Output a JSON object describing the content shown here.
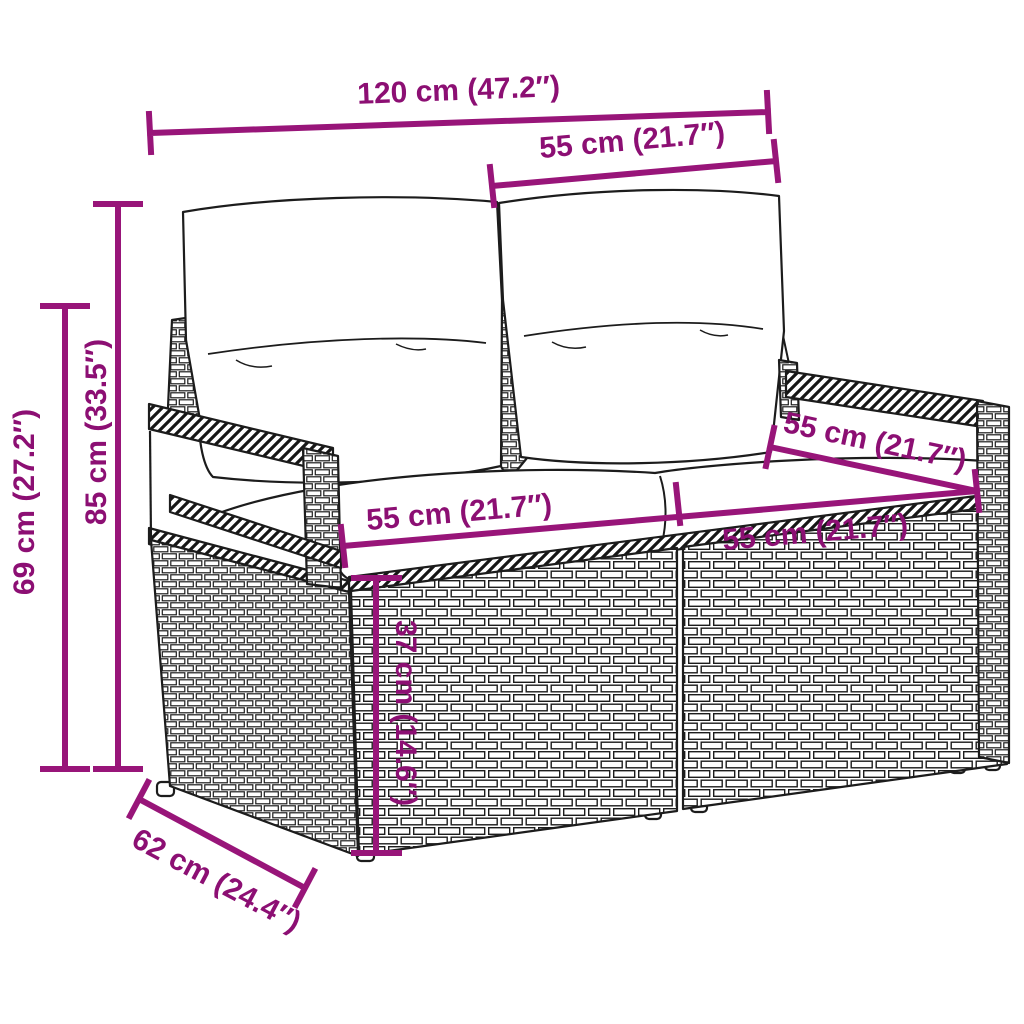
{
  "page": {
    "background": "#ffffff",
    "canvas_width": 1024,
    "canvas_height": 1024
  },
  "diagram": {
    "type": "product-dimension-diagram",
    "colors": {
      "dimension_line": "#981579",
      "dimension_text": "#8c0f73",
      "line_art": "#1c1c1c",
      "background": "#ffffff"
    },
    "dimensions": [
      {
        "id": "overall-width",
        "label": "120 cm (47.2″)"
      },
      {
        "id": "backrest-section-width",
        "label": "55 cm (21.7″)"
      },
      {
        "id": "overall-height",
        "label": "85 cm (33.5″)"
      },
      {
        "id": "armrest-height",
        "label": "69 cm (27.2″)"
      },
      {
        "id": "seat-width-left",
        "label": "55 cm (21.7″)"
      },
      {
        "id": "seat-width-right",
        "label": "55 cm (21.7″)"
      },
      {
        "id": "armrest-top-depth",
        "label": "55 cm (21.7″)"
      },
      {
        "id": "seat-height",
        "label": "37 cm (14.6″)"
      },
      {
        "id": "overall-depth",
        "label": "62 cm (24.4″)"
      }
    ]
  }
}
